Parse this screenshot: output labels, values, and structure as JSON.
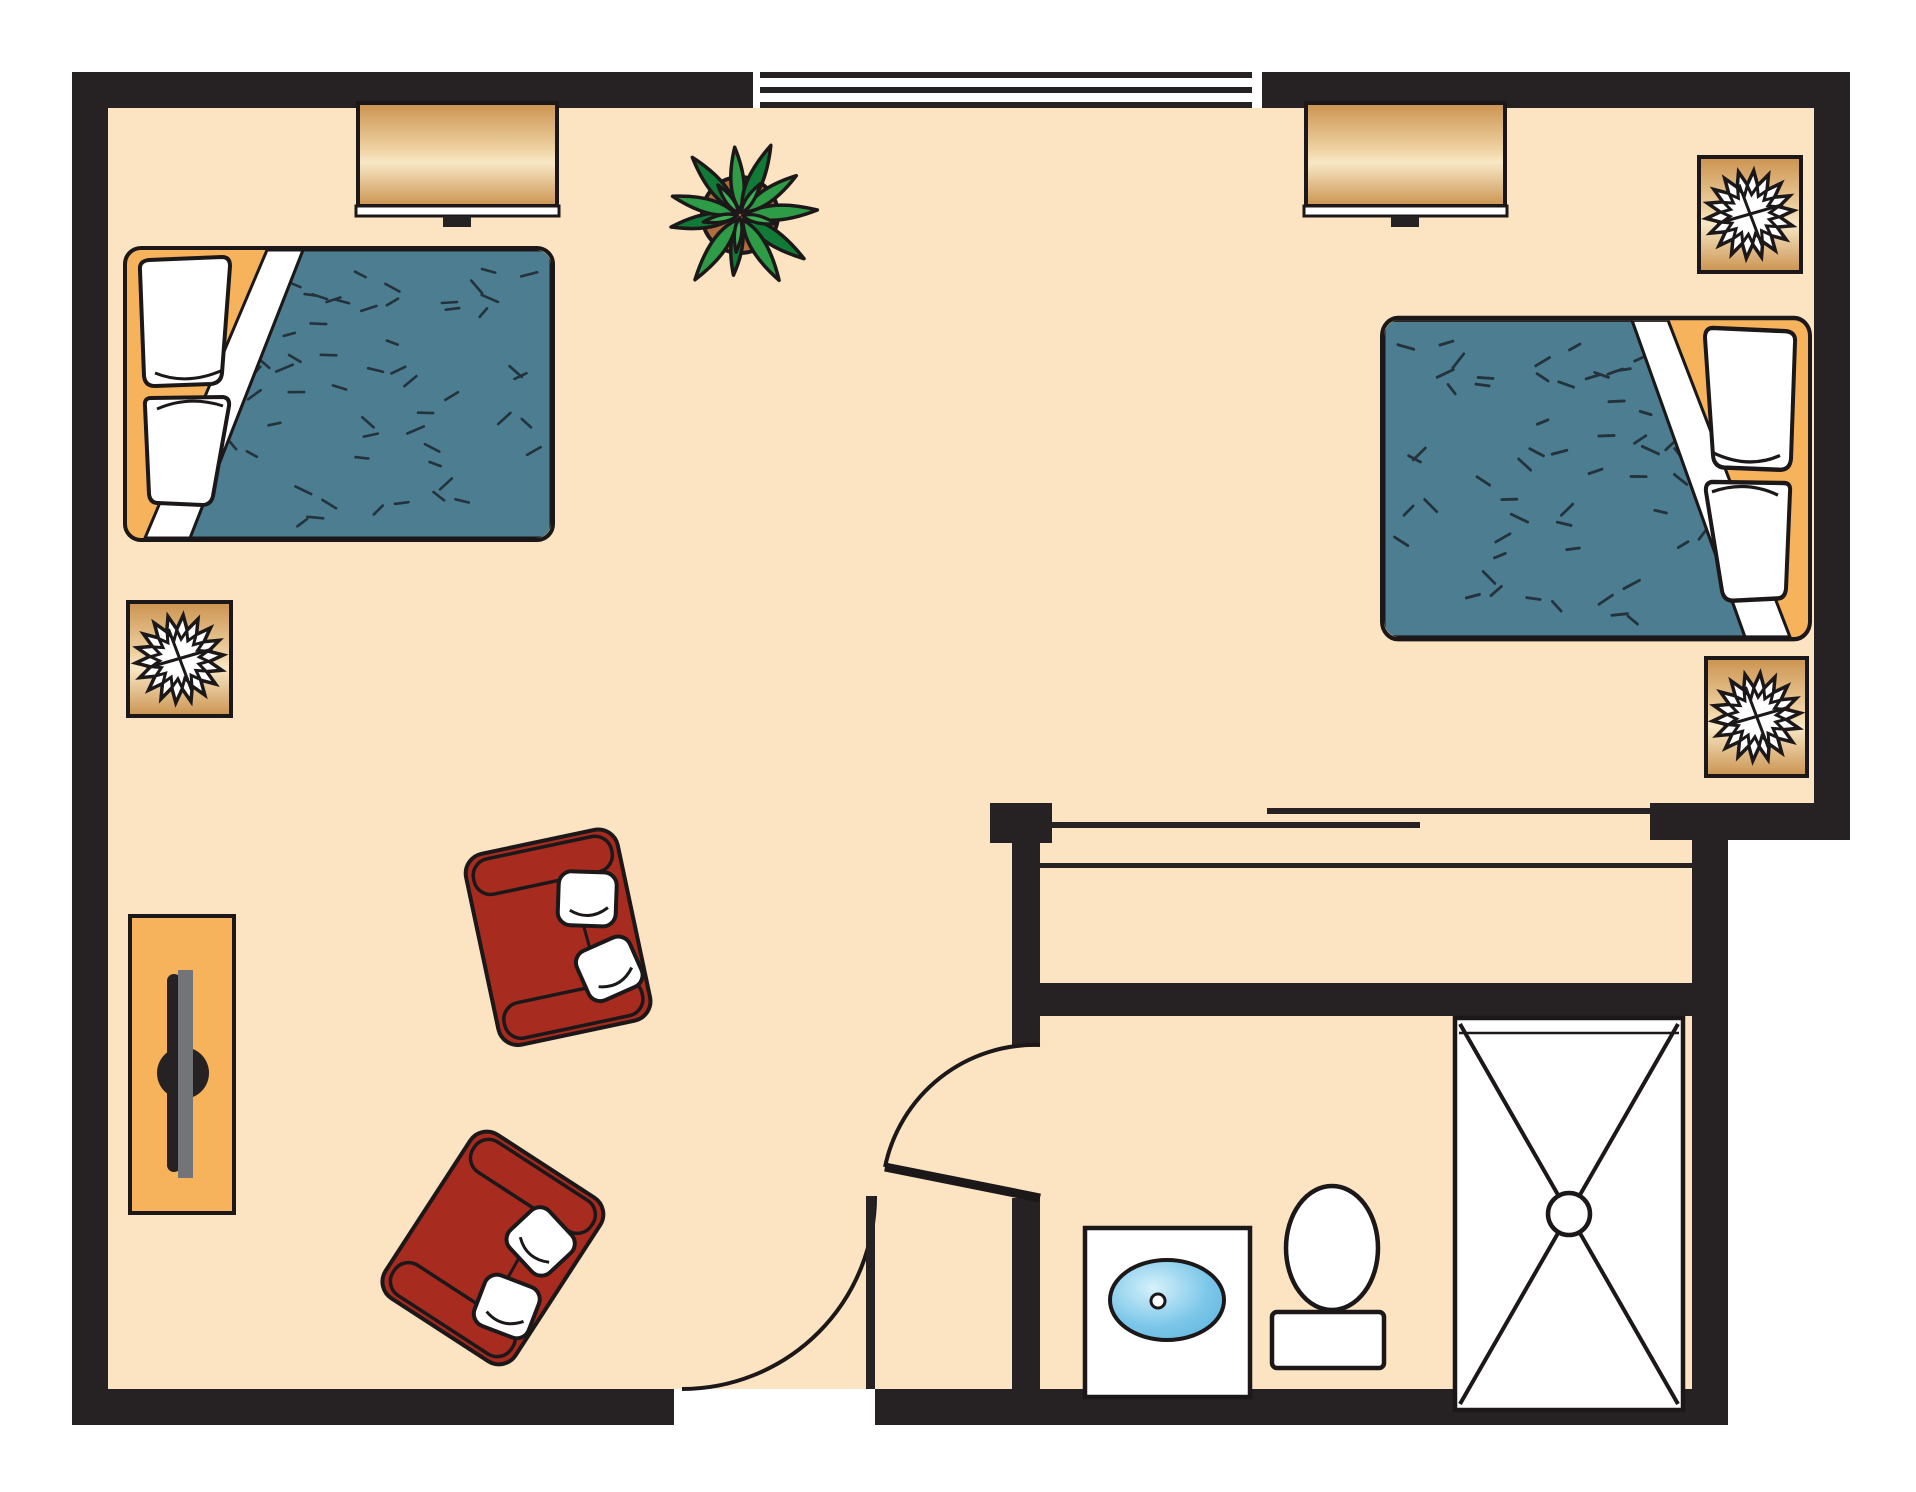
{
  "title": "shared-room-floor-plan",
  "colors": {
    "page": "#FFFFFF",
    "floor": "#FCE4C3",
    "wall": "#262122",
    "line": "#1C1819",
    "white": "#FFFFFF",
    "bed-frame": "#F7B25C",
    "blanket": "#4C7D90",
    "dash": "#24333B",
    "wood-dark": "#CB9350",
    "wood-mid": "#EFD2A2",
    "wood-light": "#F8E8C6",
    "chair": "#A82B20",
    "sink": "#7CC7E9",
    "sink-light": "#D6F1FB",
    "tv-gray": "#737477",
    "plant-dark": "#117A36",
    "plant-mid": "#2E9B47",
    "plant-light": "#3CAE54",
    "pot": "#AF6E3E"
  },
  "furniture": {
    "beds": 2,
    "dressers": 2,
    "lamp_tables": 3,
    "armchairs": 2,
    "tv_console": 1,
    "potted_plant": 1,
    "sink_vanity": 1,
    "toilet": 1,
    "shower": 1,
    "window": 1,
    "swing_doors": 2,
    "closet_sliding_doors": 1
  }
}
